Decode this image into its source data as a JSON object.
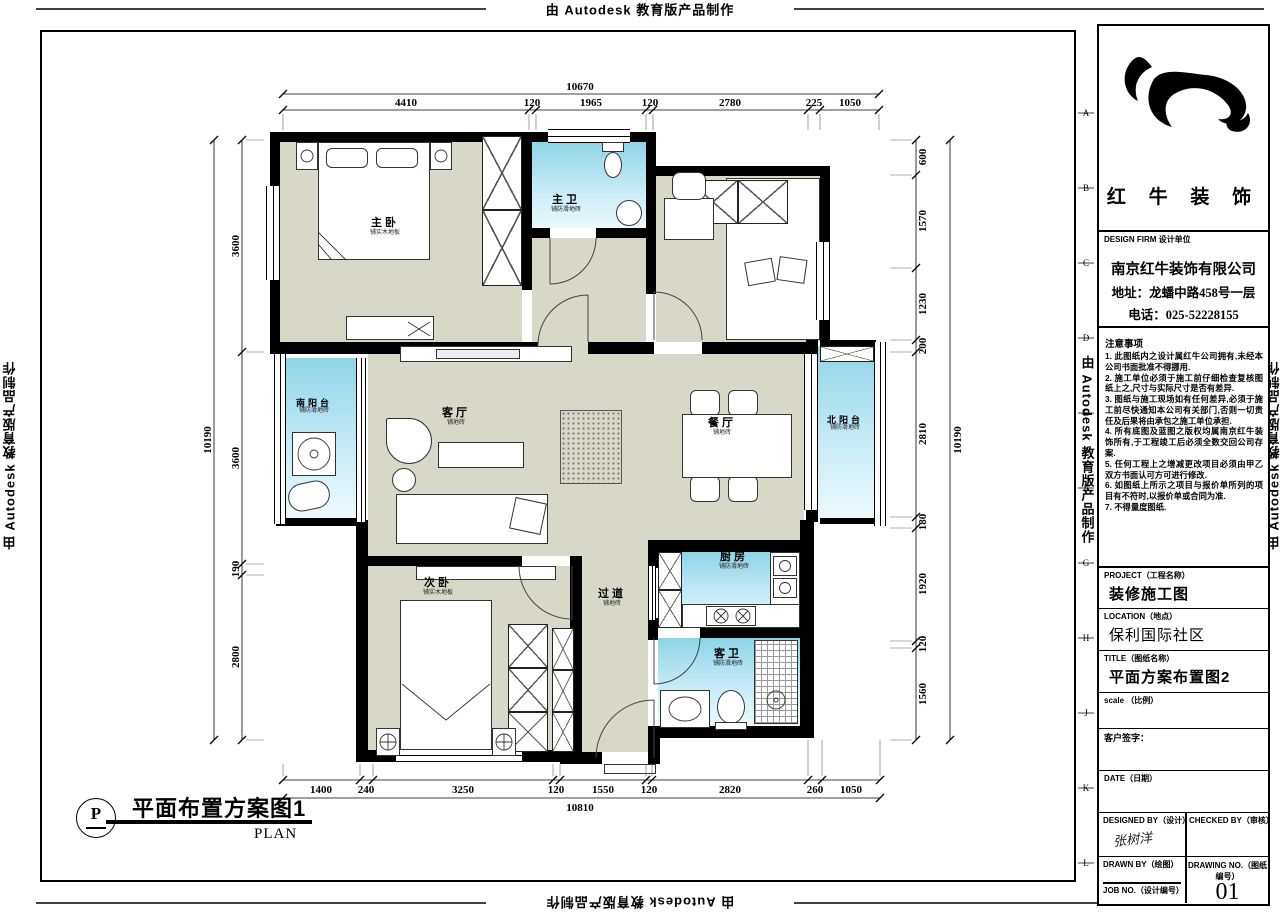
{
  "watermark": {
    "text": "由 Autodesk 教育版产品制作"
  },
  "sheet": {
    "grid_letters": [
      "A",
      "B",
      "C",
      "D",
      "E",
      "F",
      "G",
      "H",
      "J",
      "K",
      "L"
    ]
  },
  "plan": {
    "rooms": [
      {
        "name": "主卧",
        "sub": "铺实木地板"
      },
      {
        "name": "主卫",
        "sub": "铺防滑地砖"
      },
      {
        "name": "南阳台",
        "sub": "铺防滑地砖"
      },
      {
        "name": "客厅",
        "sub": "铺地砖"
      },
      {
        "name": "餐厅",
        "sub": "铺地砖"
      },
      {
        "name": "北阳台",
        "sub": "铺防滑地砖"
      },
      {
        "name": "次卧",
        "sub": "铺实木地板"
      },
      {
        "name": "过道",
        "sub": "铺地砖"
      },
      {
        "name": "厨房",
        "sub": "铺防滑地砖"
      },
      {
        "name": "客卫",
        "sub": "铺防滑地砖"
      }
    ]
  },
  "dimensions": {
    "top": {
      "total": "10670",
      "segments": [
        "4410",
        "120",
        "1965",
        "120",
        "2780",
        "225",
        "1050"
      ]
    },
    "bottom": {
      "total": "10810",
      "segments": [
        "1400",
        "240",
        "3250",
        "120",
        "1550",
        "120",
        "2820",
        "260",
        "1050"
      ]
    },
    "left": {
      "total": "10190",
      "segments": [
        "3600",
        "3600",
        "190",
        "2800"
      ]
    },
    "right": {
      "total": "10190",
      "segments": [
        "600",
        "1570",
        "1230",
        "200",
        "2810",
        "180",
        "1920",
        "120",
        "1560"
      ]
    }
  },
  "caption": {
    "marker": "P",
    "title": "平面布置方案图1",
    "subtitle": "PLAN"
  },
  "titleblock": {
    "logo_text": "红 牛 装 饰",
    "design_firm_label": "DESIGN FIRM  设计单位",
    "company": "南京红牛装饰有限公司",
    "address": "地址：龙蟠中路458号一层",
    "phone": "电话：025-52228155",
    "notes_title": "注意事项",
    "notes": [
      "1. 此图纸内之设计属红牛公司拥有,未经本公司书面批准不得挪用.",
      "2. 施工单位必须于施工前仔细检查复核图纸上之,尺寸与实际尺寸是否有差异.",
      "3. 图纸与施工现场如有任何差异,必须于施工前尽快通知本公司有关部门,否则一切责任及后果将由承包之施工单位承担.",
      "4. 所有底图及蓝图之版权均属南京红牛装饰所有,于工程竣工后必须全数交回公司存案.",
      "5. 任何工程上之增减更改项目必须由甲乙双方书面认可方可进行修改.",
      "6. 如图纸上所示之项目与报价单所列的项目有不符时,以报价单或合同为准.",
      "7. 不得量度图纸."
    ],
    "project_label": "PROJECT（工程名称）",
    "project_value": "装修施工图",
    "location_label": "LOCATION（地点）",
    "location_value": "保利国际社区",
    "title_label": "TITLE（图纸名称）",
    "title_value": "平面方案布置图2",
    "scale_label": "scale （比例）",
    "client_label": "客户签字：",
    "date_label": "DATE（日期）",
    "designed_label": "DESIGNED BY（设计）",
    "designed_signature": "张树洋",
    "checked_label": "CHECKED BY（审核）",
    "drawn_label": "DRAWN BY（绘图）",
    "job_label": "JOB NO.（设计编号）",
    "drawing_no_label": "DRAWING NO.（图纸编号）",
    "drawing_no_value": "01"
  }
}
